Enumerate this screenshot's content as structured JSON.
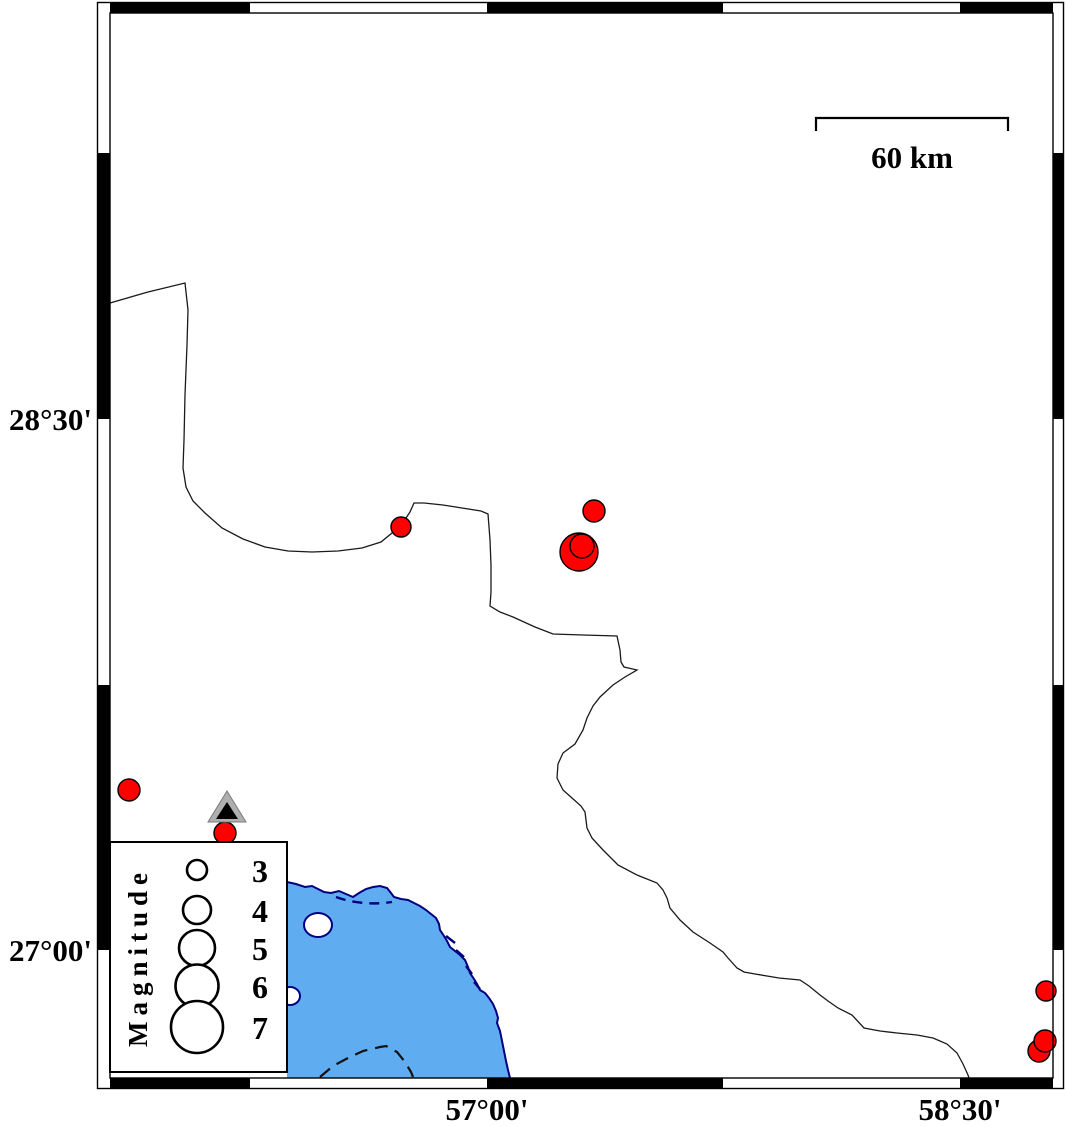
{
  "axis": {
    "lat_labels": [
      {
        "text": "28°30'",
        "y": 419
      },
      {
        "text": "27°00'",
        "y": 950
      }
    ],
    "lon_labels": [
      {
        "text": "57°00'",
        "x": 487
      },
      {
        "text": "58°30'",
        "x": 960
      }
    ]
  },
  "scale_bar": {
    "label": "60 km"
  },
  "legend": {
    "title": "Magnitude",
    "entries": [
      {
        "label": "3",
        "r": 10
      },
      {
        "label": "4",
        "r": 14
      },
      {
        "label": "5",
        "r": 18
      },
      {
        "label": "6",
        "r": 21.5
      },
      {
        "label": "7",
        "r": 26
      }
    ]
  },
  "epicenters": [
    {
      "x": 129,
      "y": 790,
      "r": 11
    },
    {
      "x": 225,
      "y": 833,
      "r": 11
    },
    {
      "x": 401,
      "y": 527,
      "r": 10
    },
    {
      "x": 594,
      "y": 511,
      "r": 11
    },
    {
      "x": 579,
      "y": 552,
      "r": 19
    },
    {
      "x": 582,
      "y": 546,
      "r": 12
    },
    {
      "x": 1046,
      "y": 991,
      "r": 10
    },
    {
      "x": 1039,
      "y": 1051,
      "r": 11
    },
    {
      "x": 1045,
      "y": 1041,
      "r": 11
    }
  ],
  "station": {
    "x": 227,
    "y": 808
  },
  "colors": {
    "epicenter_fill": "#FF0000",
    "sea_fill": "#5FADF0",
    "coast_stroke": "#000080",
    "station_fill": "#AFAFAF",
    "station_inner": "#000000",
    "frame_black": "#000000"
  }
}
